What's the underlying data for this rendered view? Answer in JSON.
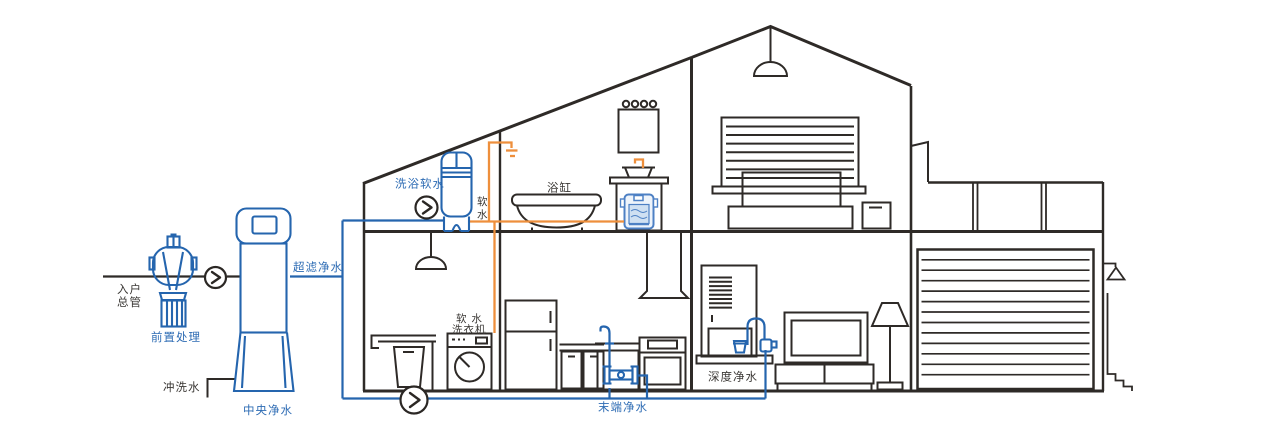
{
  "diagram": {
    "type": "whole-house water purification system cutaway diagram",
    "colors": {
      "line_black": "#2e2a27",
      "pipe_blue": "#2565ae",
      "label_blue": "#2e6cb4",
      "pipe_orange": "#ee8f3c",
      "heater_fill": "#e8f0f9",
      "background": "#ffffff"
    },
    "labels": {
      "inlet_line1": "入户",
      "inlet_line2": "总管",
      "prefilter": "前置处理",
      "central_purifier": "中央净水",
      "flush_water": "冲洗水",
      "ultrafiltration": "超滤净水",
      "bath_softener": "洗浴软水",
      "soft_water_v1": "软",
      "soft_water_v2": "水",
      "bathtub": "浴缸",
      "washer_line1": "软 水",
      "washer_line2": "洗衣机",
      "terminal_purifier": "末端净水",
      "deep_purifier": "深度净水"
    },
    "components": [
      "inlet-main-pipe",
      "pre-filter",
      "booster-valve",
      "central-purifier",
      "flush-drain",
      "ultrafiltration-pipe",
      "bath-softener-tank",
      "shower-head",
      "bathtub",
      "vanity-sink",
      "under-sink-heater",
      "mirror-with-lights",
      "soft-water-washing-machine",
      "laundry-sink",
      "fridge",
      "kitchen-cabinets",
      "kitchen-sink",
      "terminal-purifier",
      "stove-with-hood",
      "water-bar-cabinet",
      "dispenser-faucet",
      "deep-purifier-unit",
      "tv-with-stand",
      "floor-lamp",
      "bed",
      "nightstand",
      "window-blinds",
      "pendant-lamps",
      "garage-rolling-door",
      "roof-terrace-railing",
      "outdoor-lamp",
      "outdoor-steps"
    ]
  }
}
